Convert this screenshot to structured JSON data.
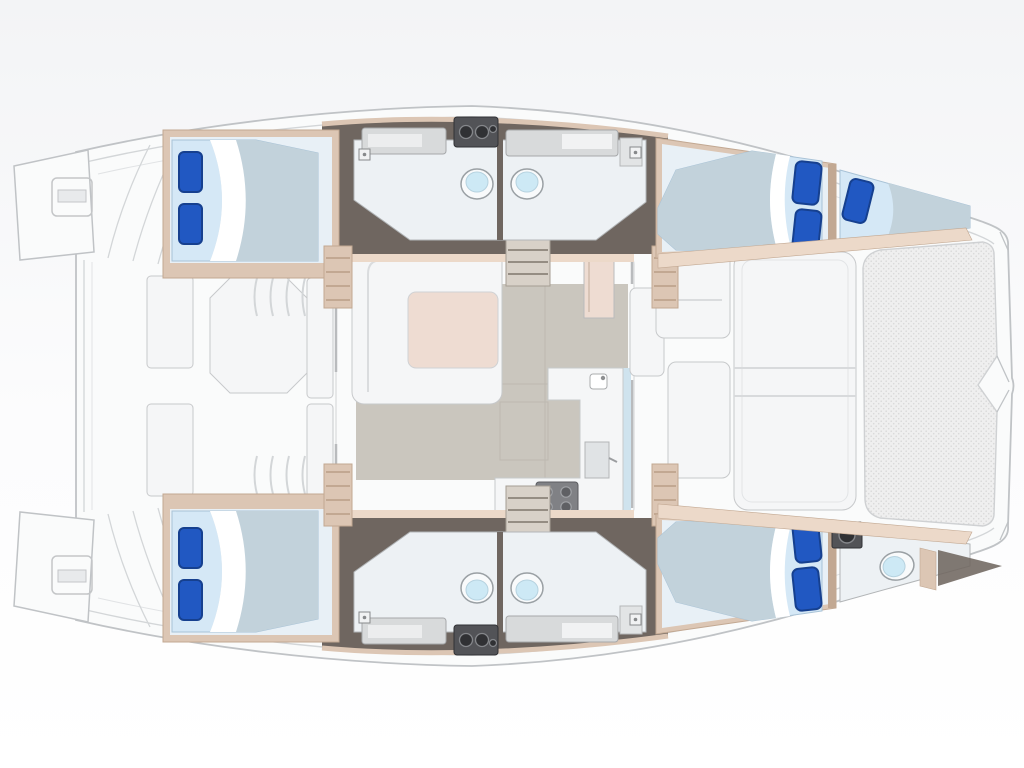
{
  "meta": {
    "title": "Catamaran yacht deck and accommodation floor plan",
    "type": "floor-plan",
    "view": "top-down",
    "orientation": "bow-right",
    "visible_text": "none"
  },
  "palette": {
    "bg": "#ffffff",
    "bg-top": "#f3f4f6",
    "deck": "#fafbfb",
    "deck-line": "#d3d6d8",
    "hull-stroke": "#c0c3c6",
    "floor-dark": "#6f6660",
    "trim": "#dcc6b4",
    "trim-dark": "#c2a892",
    "trim-light": "#ecd9c9",
    "room-floor": "#edf1f4",
    "room-stroke": "#b2b5b7",
    "cabin-floor": "#e8f0f6",
    "bed-base": "#d5e8f6",
    "bed-duvet": "#c2d2db",
    "bed-stroke": "#a8c2d6",
    "pillow": "#2158c2",
    "pillow-dark": "#16408f",
    "furniture": "#f5f6f7",
    "furniture-stroke": "#c7c9cb",
    "salon-floor": "#cac6be",
    "salon-line": "#bdb8b0",
    "table": "#eedcd2",
    "appliance": "#525357",
    "appliance-dark": "#303134",
    "appliance-ring": "#85878b",
    "stove": "#808185",
    "window-strip": "#cfe3ee",
    "toilet-lid": "#cde9f5",
    "toilet-stroke": "#9aa0a4",
    "tramp": "#efefef",
    "tramp-line": "#d9d9d9",
    "stair": "#d8d1c8",
    "stair-line": "#958d83"
  },
  "regions": {
    "plan": {
      "label": "Catamaran floor plan — bow to the right"
    },
    "deck": {
      "label": "Main deck"
    },
    "swim_platform_port": {
      "label": "Port swim platform with boarding ladder"
    },
    "swim_platform_starboard": {
      "label": "Starboard swim platform with boarding ladder"
    },
    "stern_steps_port": {
      "label": "Port transom steps"
    },
    "stern_steps_starboard": {
      "label": "Starboard transom steps"
    },
    "aft_cockpit": {
      "label": "Aft cockpit with dining table and benches"
    },
    "cockpit_table": {
      "label": "Cockpit dining table"
    },
    "salon": {
      "label": "Salon"
    },
    "salon_sofa": {
      "label": "U-shaped salon sofa"
    },
    "salon_table": {
      "label": "Salon table"
    },
    "nav_cabinet": {
      "label": "Forward cabinet / nav station"
    },
    "galley": {
      "label": "Galley with L-shaped counter"
    },
    "galley_sink": {
      "label": "Galley sink"
    },
    "galley_stove": {
      "label": "Four-burner stove"
    },
    "galley_oven": {
      "label": "Oven / refrigerator unit"
    },
    "companionway": {
      "label": "Companionway steps down to hull"
    },
    "forward_cockpit": {
      "label": "Forward cockpit seating"
    },
    "forward_lounge": {
      "label": "Forward sun lounge"
    },
    "trampoline": {
      "label": "Bow trampoline"
    },
    "bowsprit": {
      "label": "Bowsprit"
    },
    "port_hull": {
      "label": "Port hull — aft double cabin and twin heads"
    },
    "starboard_hull": {
      "label": "Starboard hull — aft double cabin and twin heads"
    },
    "aft_cabin": {
      "label": "Aft double cabin"
    },
    "heads": {
      "label": "Twin heads with toilets, vanities and shower"
    },
    "toilet": {
      "label": "Marine toilet"
    },
    "vanity": {
      "label": "Vanity with sink"
    },
    "utility_unit": {
      "label": "Utility / washer unit"
    },
    "port_forward_cabin": {
      "label": "Port forward double cabin"
    },
    "forepeak_berth": {
      "label": "Forepeak single berth"
    },
    "starboard_forward_cabin": {
      "label": "Starboard forward double cabin"
    },
    "forward_head": {
      "label": "Starboard forward head"
    },
    "bed_double": {
      "label": "Double berth with two pillows"
    },
    "bed_single": {
      "label": "Single berth with one pillow"
    }
  },
  "inventory": {
    "cabins": 4,
    "double_berths": 4,
    "single_berths": 1,
    "heads": 5,
    "toilets": 5,
    "pillows": 9,
    "salon_tables": 1,
    "cockpit_tables": 1,
    "stove_burners": 4,
    "swim_platforms": 2,
    "trampolines": 1
  }
}
